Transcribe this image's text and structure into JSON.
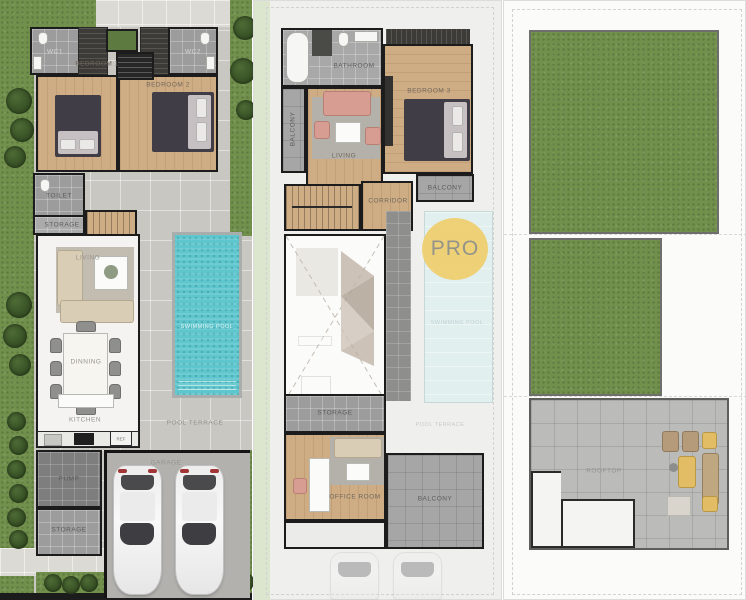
{
  "watermark": {
    "label": "PRO"
  },
  "floors": {
    "ground": {
      "wc1": "WC1",
      "wc2": "WC2",
      "bedroom1": "BEDROOM 1",
      "bedroom2": "BEDROOM 2",
      "toilet": "TOILET",
      "storage_hall": "STORAGE",
      "living": "LIVING",
      "dinning": "DINNING",
      "kitchen": "KITCHEN",
      "ref": "REF",
      "swimming_pool": "SWIMMING POOL",
      "pool_terrace": "POOL TERRACE",
      "pump": "PUMP",
      "storage_service": "STORAGE",
      "garage": "GARAGE"
    },
    "second": {
      "bathroom": "BATHROOM",
      "bedroom3": "BEDROOM 3",
      "balcony_left": "BALCONY",
      "living": "LIVING",
      "corridor": "CORRIDOR",
      "balcony_top": "BALCONY",
      "swimming_pool_below": "SWIMMING POOL",
      "pool_terrace_below": "POOL TERRACE",
      "storage": "STORAGE",
      "office": "OFFICE ROOM",
      "balcony_rear": "BALCONY"
    },
    "roof": {
      "rooftop": "ROOFTOP"
    }
  },
  "colors": {
    "pool_water": "#5ec6cd",
    "grass": "#71904c",
    "wood_floor": "#cfad84",
    "watermark_yellow": "#f0cf6e",
    "wall": "#1c1c1c"
  }
}
